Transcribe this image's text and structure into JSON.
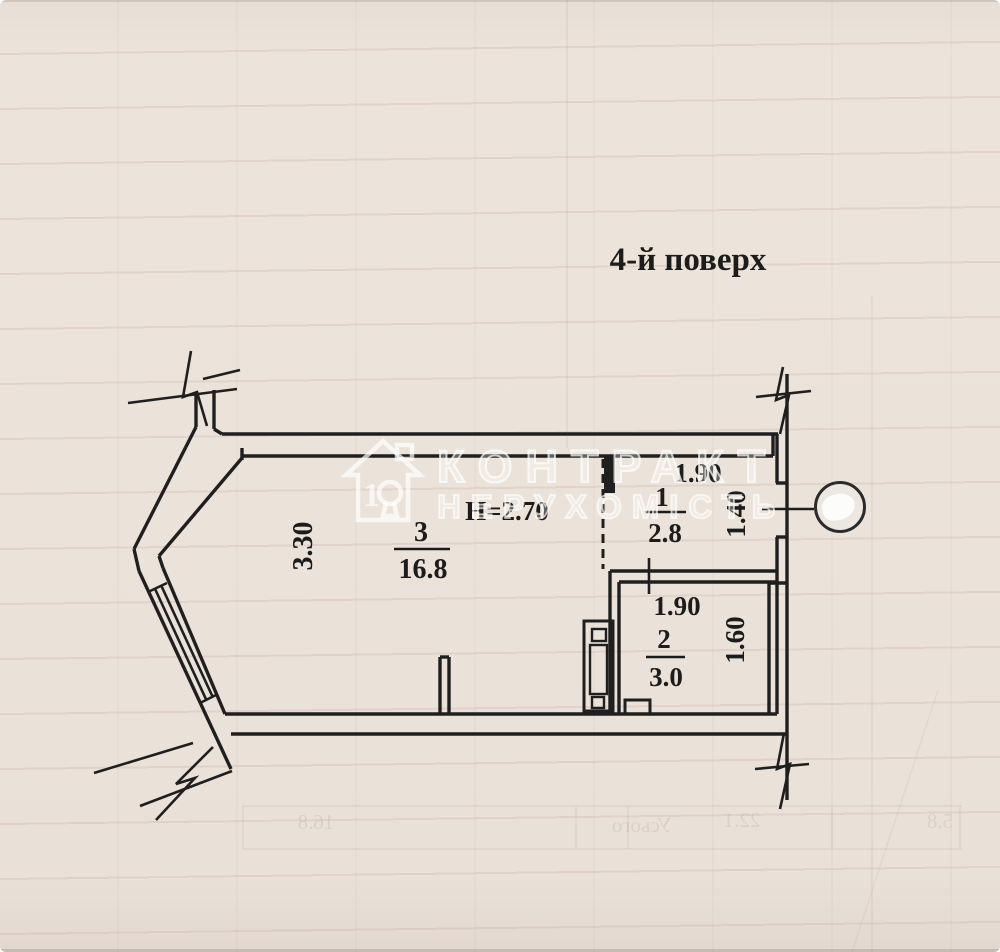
{
  "page": {
    "title": "4-й поверх"
  },
  "plan": {
    "ceiling_height": "Н=2.70",
    "rooms": [
      {
        "number": "3",
        "area": "16.8",
        "dim": "3.30"
      },
      {
        "number": "1",
        "area": "2.8",
        "dim_top": "1.90",
        "dim_side": "1.40"
      },
      {
        "number": "2",
        "area": "3.0",
        "dim_top": "1.90",
        "dim_side": "1.60"
      }
    ]
  },
  "watermark": {
    "line1": "КОНТРАКТ",
    "line2": "НЕРУХОМІСТЬ",
    "logo_digit": "1"
  },
  "ghost_text": {
    "w1": "Усього",
    "v1": "22.1",
    "v2": "16.8",
    "v3": "5.8"
  },
  "colors": {
    "ink": "#1c1c1c",
    "paper": "#ebe3da",
    "watermark": "#ffffff"
  }
}
